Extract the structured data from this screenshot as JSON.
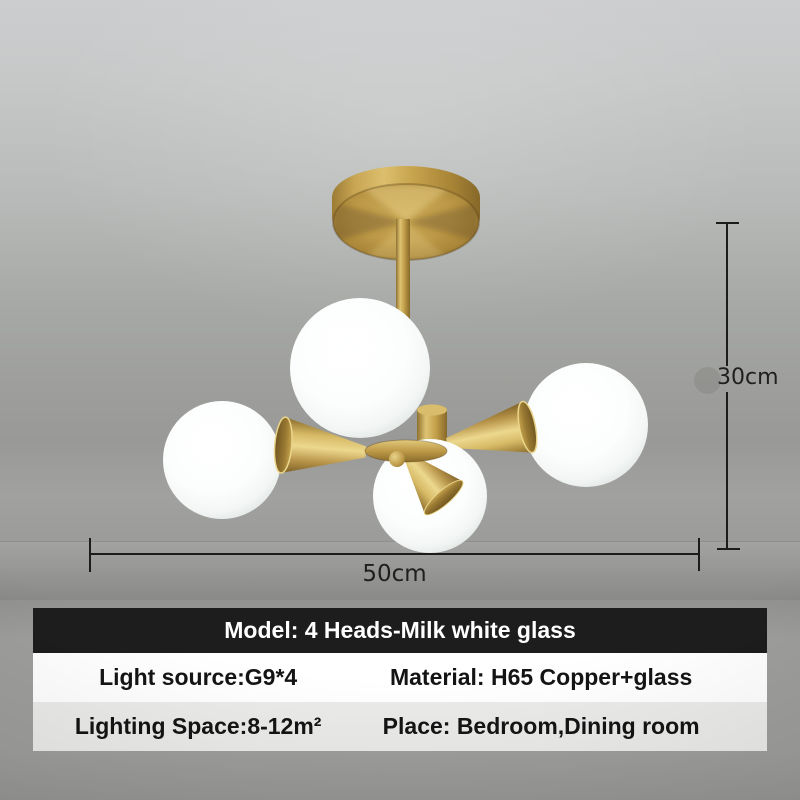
{
  "colors": {
    "background_top": "#cccdcf",
    "background_mid": "#9e9f9c",
    "background_bottom": "#979795",
    "brass": "#c2a14a",
    "brass_highlight": "#e5cd83",
    "brass_shadow": "#8a6b2a",
    "glass_white": "#fbfdfc",
    "annotation_line": "#1c1c1c",
    "table_header_bg": "#1d1d1d",
    "table_header_text": "#ffffff",
    "table_row_white_bg": "#ffffff",
    "table_row_gray_bg": "#ebebea",
    "table_text": "#141414"
  },
  "annotations": {
    "height_label": "30cm",
    "width_label": "50cm"
  },
  "spec_table": {
    "header": "Model: 4 Heads-Milk white glass",
    "rows": [
      {
        "left": "Light source:G9*4",
        "right": "Material: H65 Copper+glass"
      },
      {
        "left": "Lighting Space:8-12m²",
        "right": "Place: Bedroom,Dining room"
      }
    ]
  },
  "product_illustration": {
    "parts": [
      "ceiling-canopy",
      "stem-rod",
      "center-hub",
      "hub-disc",
      "hub-knob",
      "cone-arm-left",
      "cone-arm-right",
      "cone-arm-bottom",
      "glass-globe-top",
      "glass-globe-left",
      "glass-globe-right",
      "glass-globe-bottom",
      "smudge-dot"
    ]
  }
}
